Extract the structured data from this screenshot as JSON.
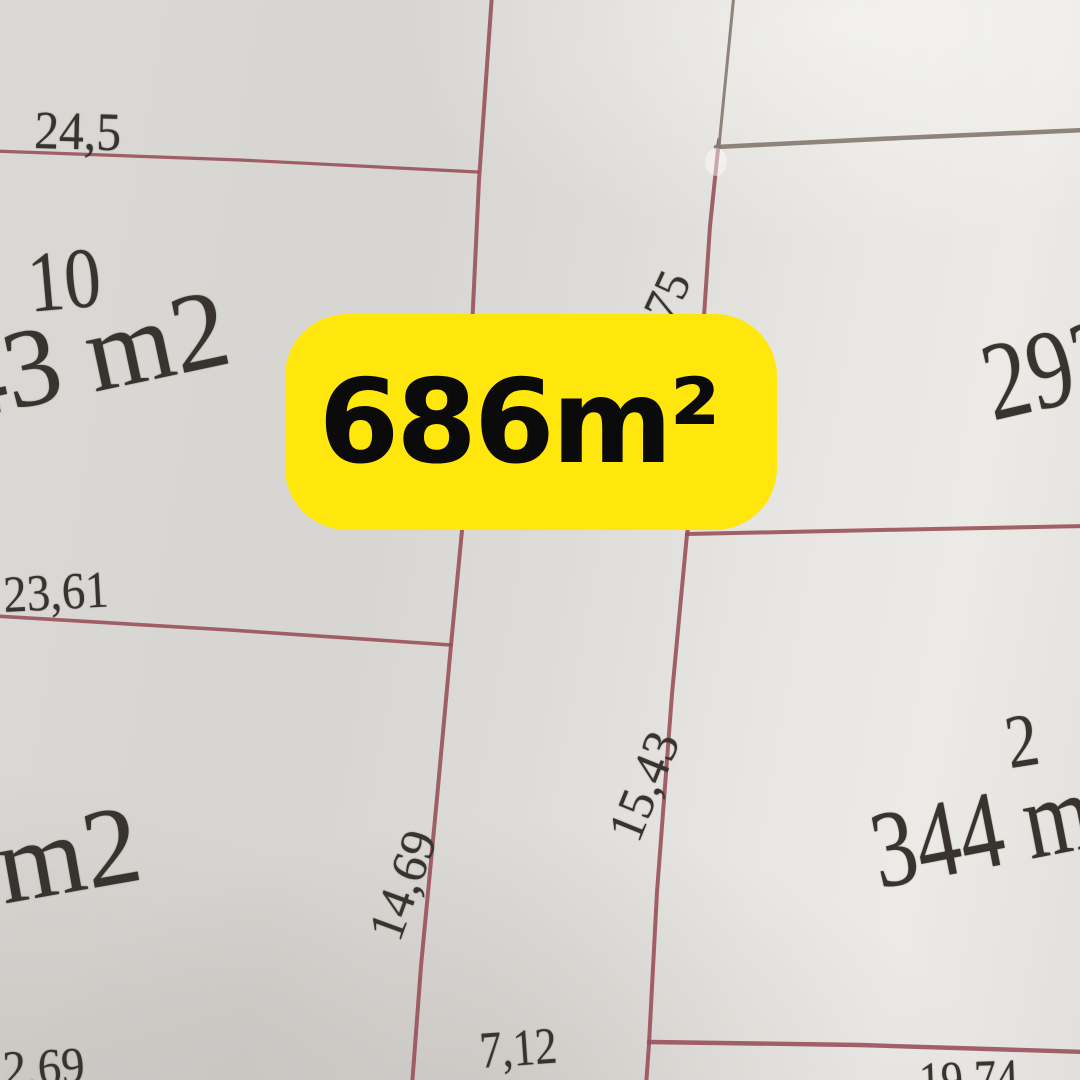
{
  "badge": {
    "area_label": "686m²"
  },
  "labels": {
    "top_width": "24,5",
    "parcel10_number": "10",
    "parcel10_area": "43 m2",
    "mid_width": "23,61",
    "lower_left_area": "m2",
    "bottom_left_width": "22,69",
    "left_depth": "14,69",
    "center_depth": "15,43",
    "partial_depth": "75",
    "bottom_center_width": "7,12",
    "bottom_right_width": "19,74",
    "right_area_partial": "293",
    "parcel2_number": "2",
    "parcel2_area": "344 m2"
  },
  "colors": {
    "badge_bg": "#ffe70d",
    "badge_ink": "#0b0b0b",
    "line_red": "#974c55",
    "line_grey": "#867b72",
    "ink": "#38332f"
  }
}
